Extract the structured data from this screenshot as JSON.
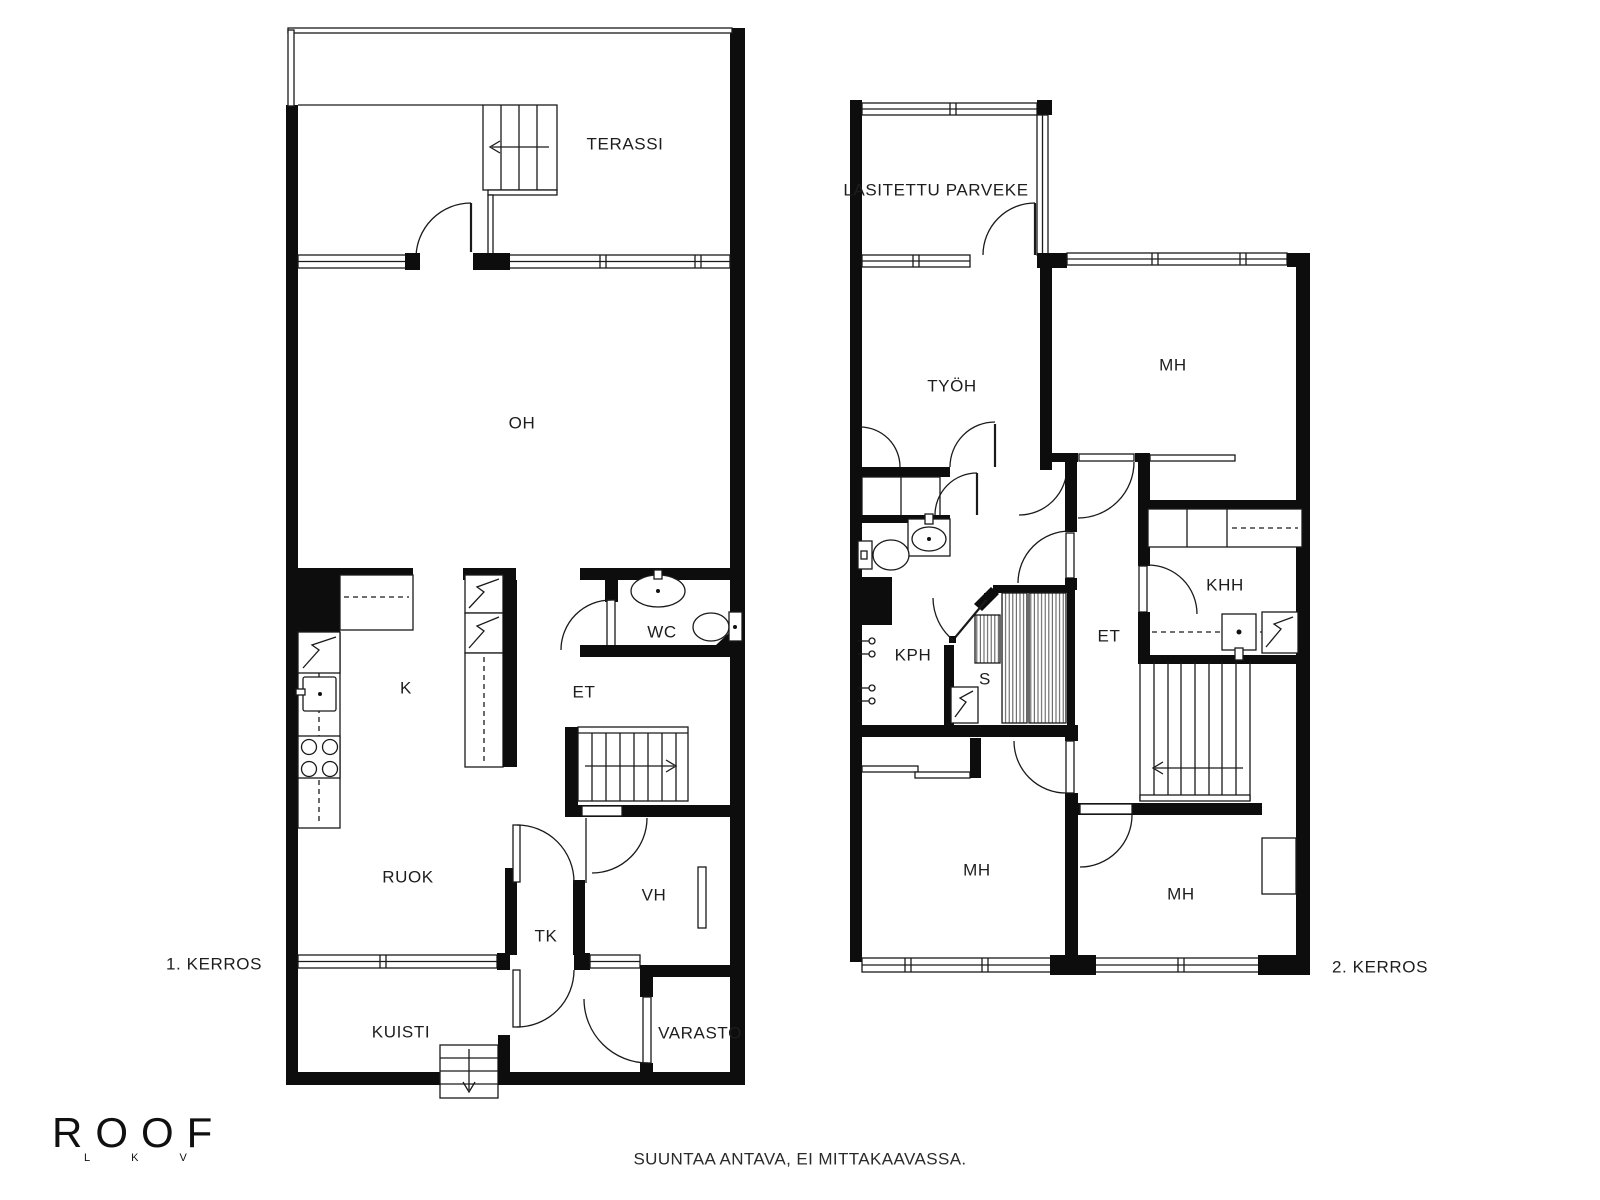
{
  "meta": {
    "background_color": "#ffffff",
    "wall_color": "#0d0d0d",
    "line_color": "#1a1a1a",
    "text_color": "#1d1d1d"
  },
  "floor1": {
    "caption": "1. KERROS",
    "rooms": [
      {
        "id": "terassi",
        "label": "TERASSI",
        "x": 625,
        "y": 144
      },
      {
        "id": "oh",
        "label": "OH",
        "x": 522,
        "y": 423
      },
      {
        "id": "k",
        "label": "K",
        "x": 406,
        "y": 688
      },
      {
        "id": "wc",
        "label": "WC",
        "x": 662,
        "y": 632
      },
      {
        "id": "et",
        "label": "ET",
        "x": 584,
        "y": 692
      },
      {
        "id": "ruok",
        "label": "RUOK",
        "x": 408,
        "y": 877
      },
      {
        "id": "tk",
        "label": "TK",
        "x": 546,
        "y": 936
      },
      {
        "id": "vh",
        "label": "VH",
        "x": 654,
        "y": 895
      },
      {
        "id": "kuisti",
        "label": "KUISTI",
        "x": 401,
        "y": 1032
      },
      {
        "id": "varasto",
        "label": "VARASTO",
        "x": 700,
        "y": 1033
      }
    ]
  },
  "floor2": {
    "caption": "2. KERROS",
    "rooms": [
      {
        "id": "parveke",
        "label": "LASITETTU PARVEKE",
        "x": 936,
        "y": 190
      },
      {
        "id": "tyoh",
        "label": "TYÖH",
        "x": 952,
        "y": 386
      },
      {
        "id": "mh-ylh",
        "label": "MH",
        "x": 1173,
        "y": 365
      },
      {
        "id": "kph",
        "label": "KPH",
        "x": 913,
        "y": 655
      },
      {
        "id": "s",
        "label": "S",
        "x": 985,
        "y": 679
      },
      {
        "id": "et2",
        "label": "ET",
        "x": 1109,
        "y": 636
      },
      {
        "id": "khh",
        "label": "KHH",
        "x": 1225,
        "y": 585
      },
      {
        "id": "mh-vasen",
        "label": "MH",
        "x": 977,
        "y": 870
      },
      {
        "id": "mh-oikea",
        "label": "MH",
        "x": 1181,
        "y": 894
      }
    ]
  },
  "footer": {
    "note": "SUUNTAA ANTAVA, EI MITTAKAAVASSA."
  },
  "logo": {
    "title": "ROOF",
    "subtitle": "LKV"
  }
}
